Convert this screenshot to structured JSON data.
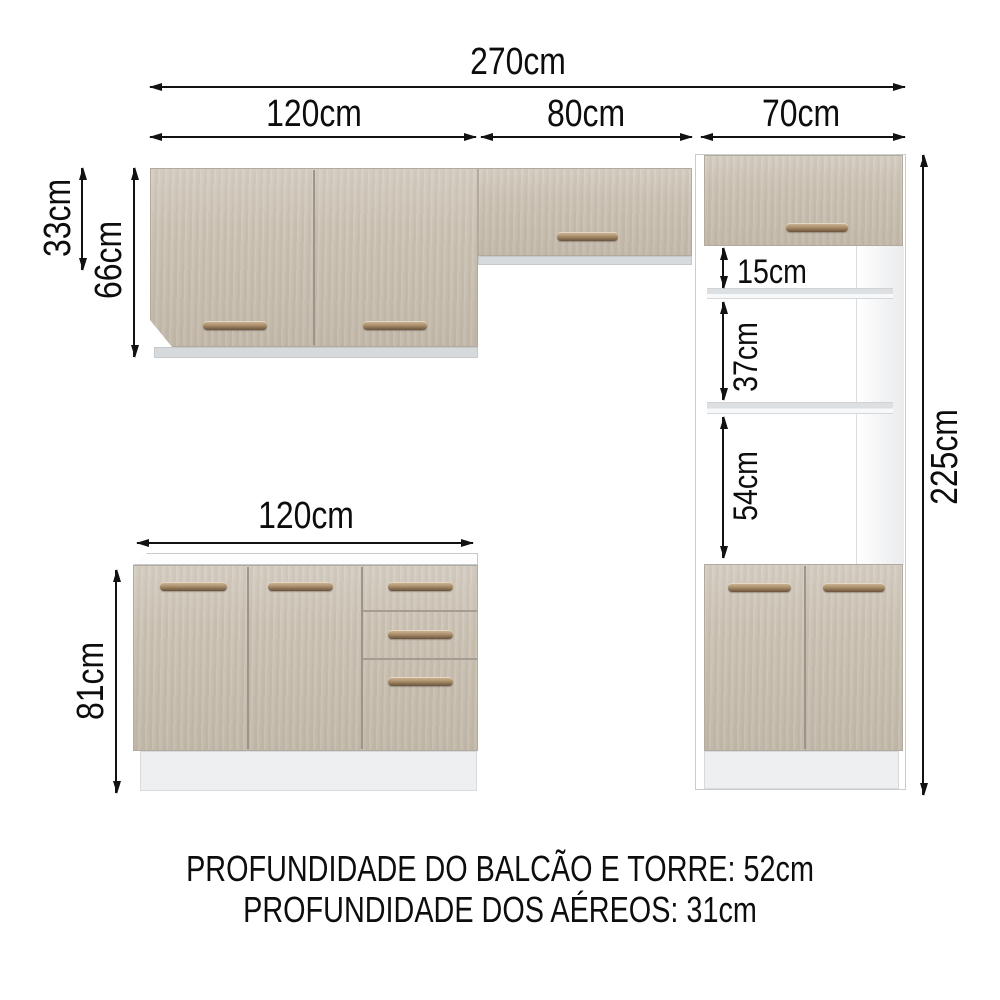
{
  "diagram": {
    "title": "kitchen-cabinet-dimension-diagram",
    "dims": {
      "total_width": "270cm",
      "wall_left_width": "120cm",
      "wall_middle_width": "80cm",
      "tower_width": "70cm",
      "wall_middle_height": "33cm",
      "wall_left_height": "66cm",
      "tower_top_gap": "15cm",
      "tower_middle_shelf": "37cm",
      "tower_lower_shelf": "54cm",
      "tower_height": "225cm",
      "base_width": "120cm",
      "base_height": "81cm"
    },
    "footer": {
      "line1": "PROFUNDIDADE DO BALCÃO E TORRE: 52cm",
      "line2": "PROFUNDIDADE DOS AÉREOS: 31cm"
    },
    "colors": {
      "door_wood": "#cbc2b4",
      "carcass_white": "#ffffff",
      "plinth_gray": "#edeff1",
      "handle_bronze": "#8a6e50",
      "dimension_text": "#0d0d0d"
    }
  }
}
